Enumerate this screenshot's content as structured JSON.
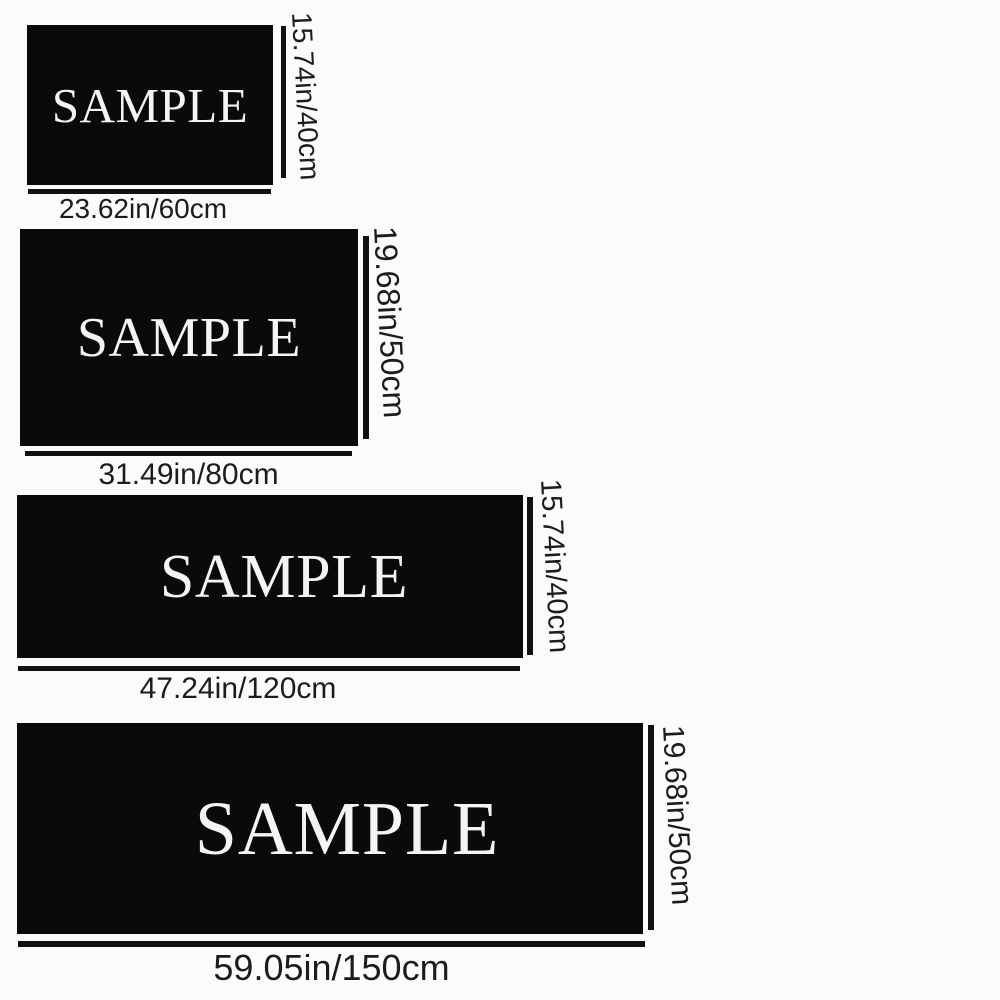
{
  "title": "rug-size-chart",
  "colors": {
    "background": "#fbfbfb",
    "swatch": "#0a0a0a",
    "line": "#111111",
    "dimension_text": "#1c1c1c",
    "sample_text": "#f4f4f4"
  },
  "items": [
    {
      "sample_label": "SAMPLE",
      "width_label": "23.62in/60cm",
      "height_label": "15.74in/40cm",
      "width_in": 23.62,
      "width_cm": 60,
      "height_in": 15.74,
      "height_cm": 40
    },
    {
      "sample_label": "SAMPLE",
      "width_label": "31.49in/80cm",
      "height_label": "19.68in/50cm",
      "width_in": 31.49,
      "width_cm": 80,
      "height_in": 19.68,
      "height_cm": 50
    },
    {
      "sample_label": "SAMPLE",
      "width_label": "47.24in/120cm",
      "height_label": "15.74in/40cm",
      "width_in": 47.24,
      "width_cm": 120,
      "height_in": 15.74,
      "height_cm": 40
    },
    {
      "sample_label": "SAMPLE",
      "width_label": "59.05in/150cm",
      "height_label": "19.68in/50cm",
      "width_in": 59.05,
      "width_cm": 150,
      "height_in": 19.68,
      "height_cm": 50
    }
  ]
}
